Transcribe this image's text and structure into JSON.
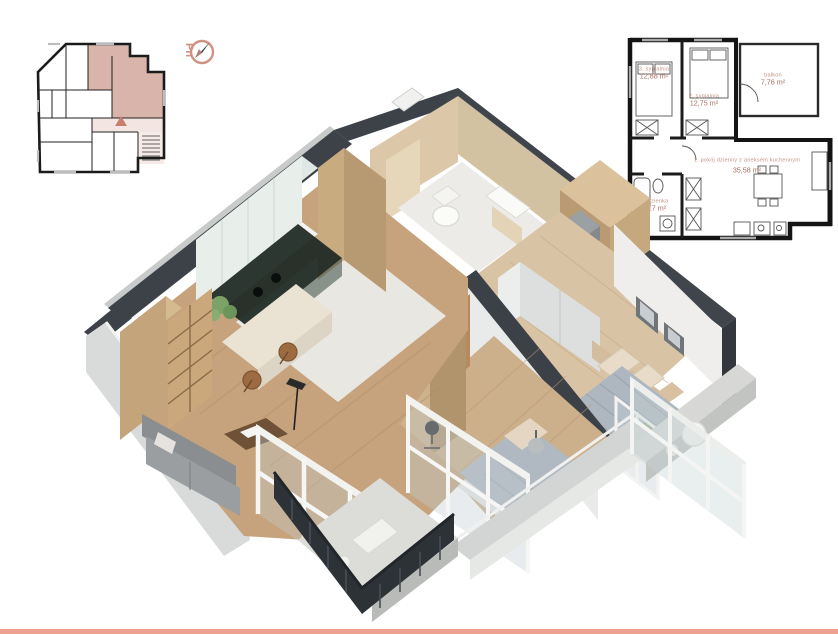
{
  "page": {
    "background": "#ffffff",
    "accent_color": "#cf9181",
    "highlight_color": "#d9b4ab",
    "footer_bar_color": "#efa18f"
  },
  "compass": {
    "label": "Pn"
  },
  "unit_plan": {
    "rooms": [
      {
        "label": "1. pokój dzienny z aneksem kuchennym",
        "area": "35,58 m²"
      },
      {
        "label": "2. sypialnia",
        "area": "12,75 m²"
      },
      {
        "label": "3. sypialnia",
        "area": "12,88 m²"
      },
      {
        "label": "4. łazienka",
        "area": "6,17 m²"
      },
      {
        "label": "balkon",
        "area": "7,76 m²"
      }
    ]
  }
}
